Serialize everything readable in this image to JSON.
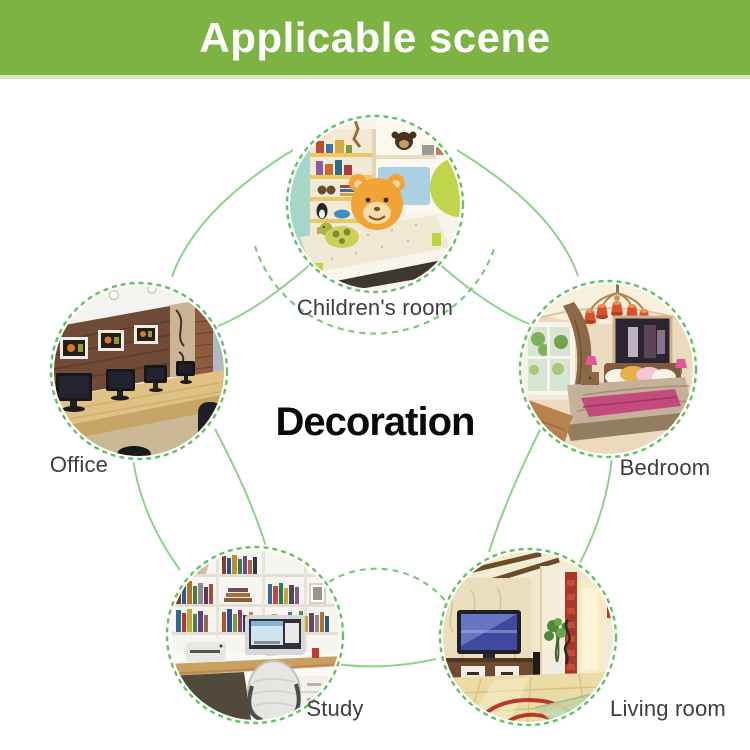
{
  "banner": {
    "title": "Applicable scene"
  },
  "center": {
    "title": "Decoration"
  },
  "scenes": [
    {
      "id": "children-room",
      "label": "Children's room"
    },
    {
      "id": "office",
      "label": "Office"
    },
    {
      "id": "bedroom",
      "label": "Bedroom"
    },
    {
      "id": "study",
      "label": "Study"
    },
    {
      "id": "living-room",
      "label": "Living room"
    }
  ],
  "colors": {
    "banner_bg": "#7db342",
    "banner_text": "#ffffff",
    "dashed_ring": "#63c063",
    "connector_line": "#8ed28a",
    "label_text": "#3d3d3d",
    "center_text": "#0a0a0a"
  }
}
